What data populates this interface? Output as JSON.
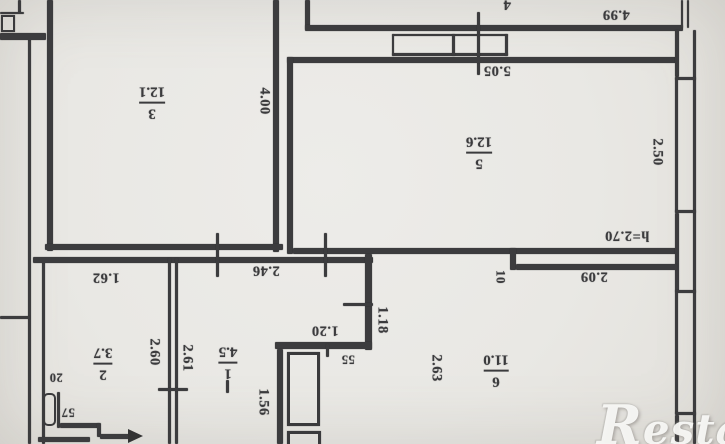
{
  "plan": {
    "paper_color": "#e9e8e4",
    "ink_color": "#3c3c3e",
    "orientation_note": "scanned floor plan rotated 180 degrees",
    "ceiling_height_note": "h=2.70",
    "rooms": [
      {
        "number": "3",
        "area": "12.1"
      },
      {
        "number": "5",
        "area": "12.6"
      },
      {
        "number": "1",
        "area": "4.5"
      },
      {
        "number": "2",
        "area": "3.7"
      },
      {
        "number": "6",
        "area": "11.0"
      },
      {
        "number": "4",
        "area": ""
      }
    ],
    "dimensions": {
      "top_width": "4.99",
      "room5_width": "5.05",
      "room3_height": "4.00",
      "room5_window": "2.50",
      "niche_width": "2.09",
      "wall_step": "10",
      "room6_wall": "1.18",
      "room6_width": "2.63",
      "room2_width": "1.62",
      "hall_width": "2.46",
      "room2_height": "2.60",
      "room1_height": "2.61",
      "closet_width": "1.20",
      "closet_step": "55",
      "shaft_height": "1.56",
      "small_dim_20": "20",
      "small_dim_57": "57"
    }
  },
  "watermark": {
    "text": "Restate"
  }
}
